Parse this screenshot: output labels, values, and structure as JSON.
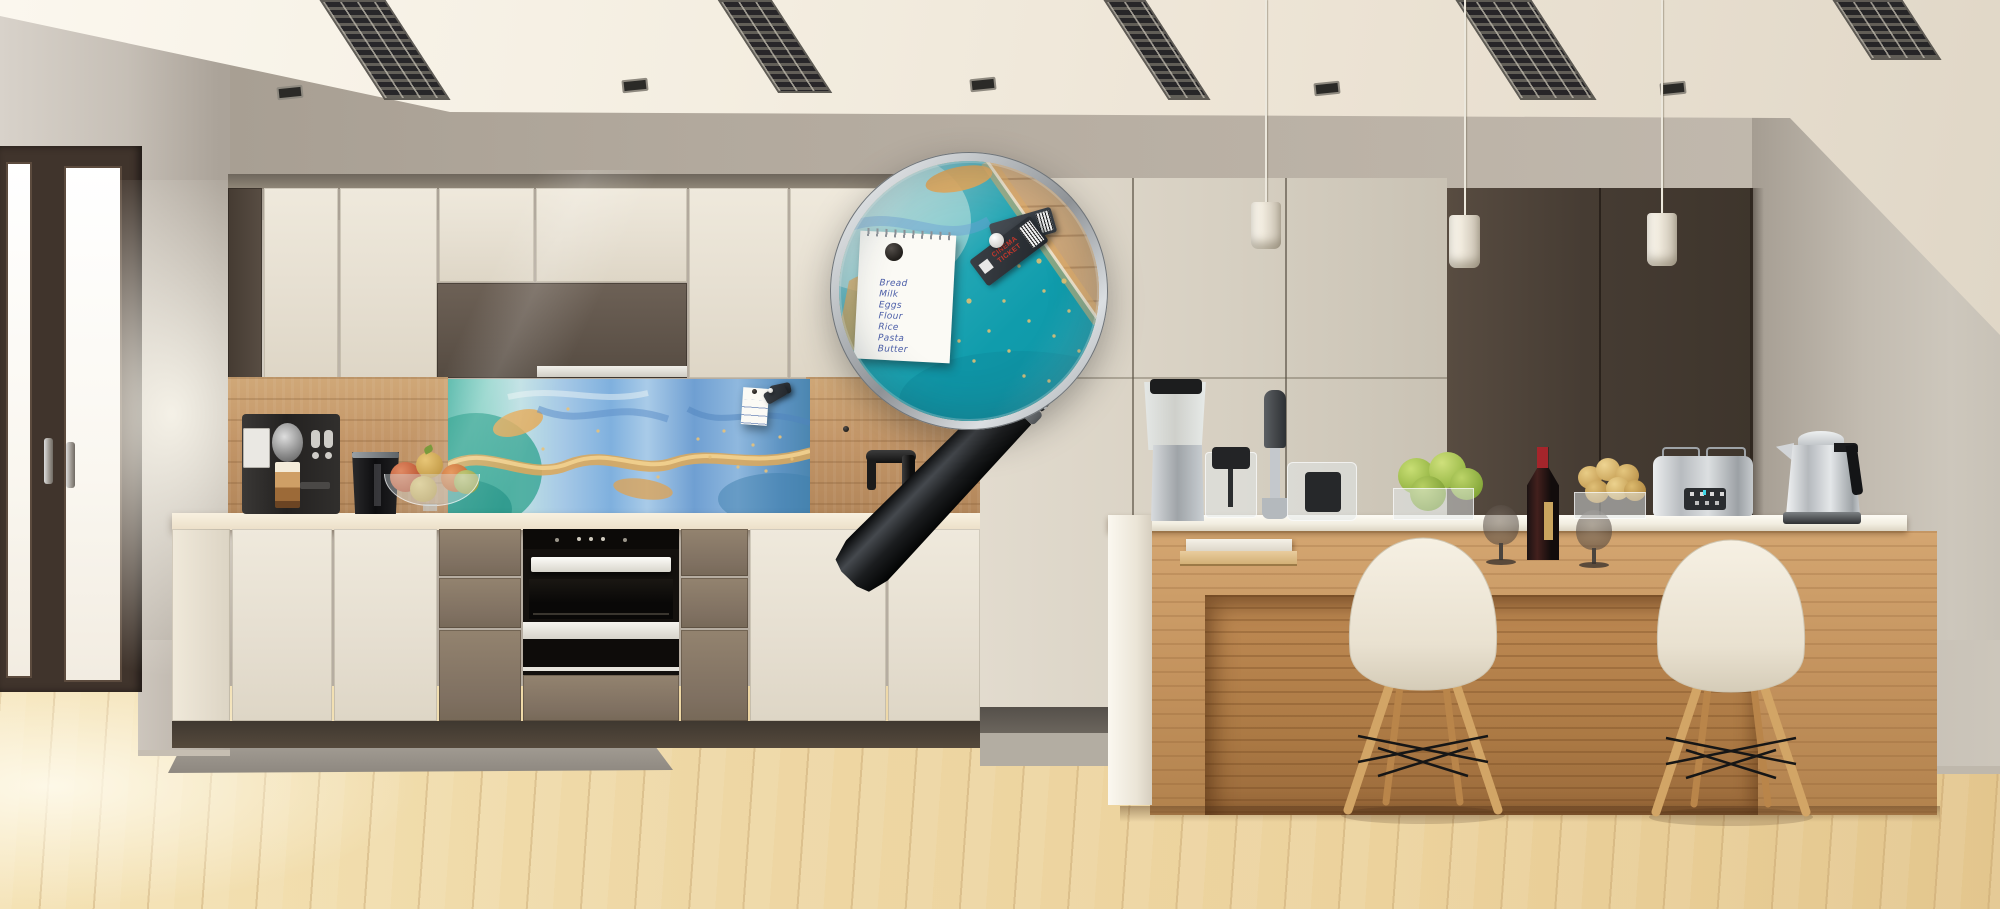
{
  "scene": {
    "description": "Modern kitchen with teal-and-gold printed glass splashback; a magnifying glass enlarges a pinned shopping list and cinema tickets",
    "magnifier_note": {
      "lines": [
        "Bread",
        "Milk",
        "Eggs",
        "Flour",
        "Rice",
        "Pasta",
        "Butter"
      ]
    },
    "cinema_ticket": {
      "label": "CINEMA TICKET"
    },
    "palette": {
      "ceiling": "#f3ecdf",
      "wall": "#b6ada1",
      "cabinet_cream": "#e7e0d2",
      "cabinet_brown": "#60544a",
      "tall_dark_cabinet": "#463c33",
      "wood_backsplash": "#c19468",
      "splashback_teal": "#129fb0",
      "splashback_gold": "#dfa95f",
      "splashback_blue": "#7aa8d8",
      "island_wood": "#c2915c",
      "counter": "#f2ead9",
      "floor": "#eed7a4",
      "chair_shell": "#efe8da",
      "ticket_red": "#c2372c",
      "wine_cap_red": "#a5252b"
    }
  }
}
